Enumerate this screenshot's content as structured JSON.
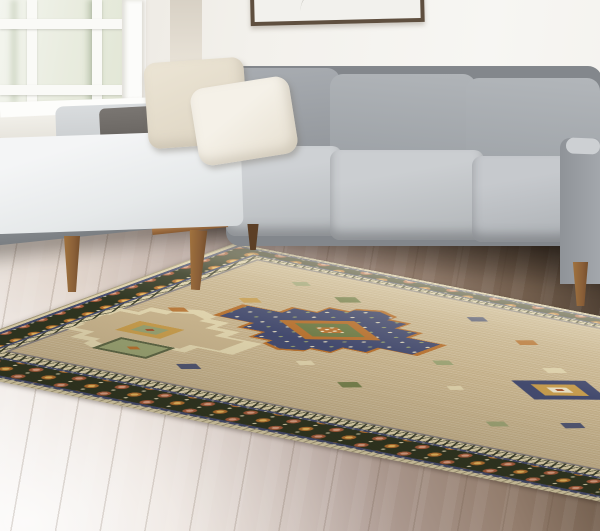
{
  "scene": {
    "type": "photograph",
    "description": "Living room product photo: beige and olive tribal medallion area rug laid on a light wood plank floor in front of a light gray sectional sofa with a chaise, wooden tapered legs, ivory throw pillows, a white-framed window at left, and a partially cropped framed artwork on the wall.",
    "objects": {
      "wall": "white wall with soft daylight",
      "window": "white-framed window with pale foliage visible outside",
      "artwork": "partially cropped framed artwork in a thin dark frame",
      "sofa": "light gray fabric sectional sofa with chaise, walnut base rail and tapered legs",
      "pillows": "two ivory throw pillows and one charcoal bolster cushion",
      "floor": "light wood plank floor fading from bright white to dark brown",
      "rug": "beige tribal medallion area rug with dark olive floral border, navy guard stripes, zigzag band, stepped navy and rust medallions, and scattered geometric motifs"
    }
  },
  "palette": {
    "wall": "#f3f1ec",
    "wall_shadow": "#d8d1c5",
    "window_frame": "#fbfbf9",
    "glass": "#e9ecdf",
    "glass_tree": "#b4bfa6",
    "art_frame": "#5f4f3f",
    "art_paper": "#f2f1ed",
    "sofa_gray": "#a3a7ac",
    "sofa_gray_light": "#d9dcde",
    "sofa_gray_dark": "#84888c",
    "bolster_charcoal": "#6e6a66",
    "pillow_cream": "#ece5d5",
    "pillow_ivory": "#f5f1e8",
    "wood_rail": "#a97c4f",
    "wood_leg": "#8a5f38",
    "floor_light": "#f3efec",
    "floor_mauve": "#b2a098",
    "floor_brown": "#6f5b4a",
    "floor_dark": "#2c231b",
    "rug_field": "#c6b28c",
    "rug_cream": "#ded2ac",
    "rug_border_olive": "#2e3420",
    "rug_navy": "#434a6e",
    "rug_rust": "#b5702f",
    "rug_salmon": "#dda184",
    "rug_gold": "#c59b4d",
    "rug_green": "#6d7a46",
    "rug_sage": "#97a071"
  }
}
